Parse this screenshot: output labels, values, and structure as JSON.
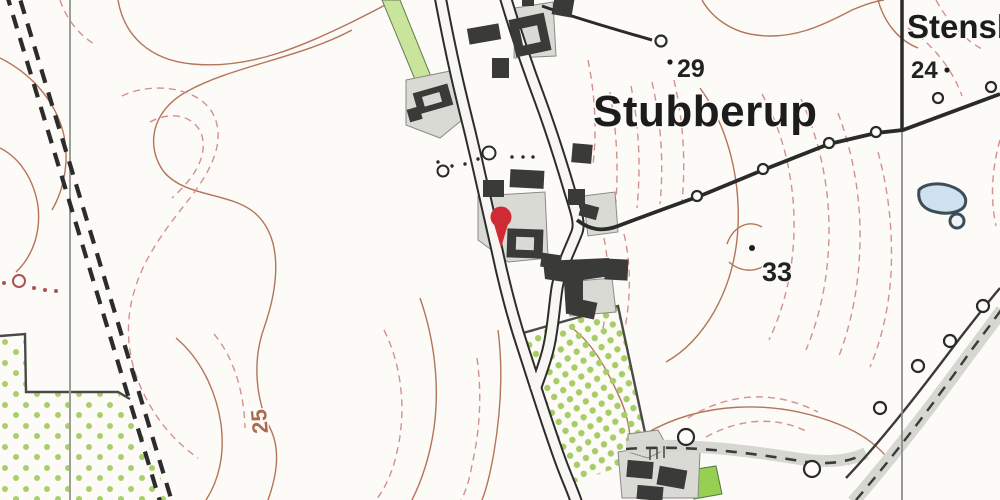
{
  "map": {
    "kind": "topographic-map",
    "labels": {
      "village": "Stubberup",
      "place_top_right": "Stensb",
      "spot_height_29": "29",
      "spot_height_33": "33",
      "spot_height_24": "24",
      "contour_label_25": "25"
    },
    "marker": {
      "type": "location-pin",
      "color": "#d02b35",
      "x": 500,
      "y": 218
    },
    "colors": {
      "background": "#fcfbf7",
      "contour_solid": "#b5745a",
      "contour_dashed": "#d4908e",
      "vegetation_dot": "#a9cf6c",
      "vegetation_strip": "#c9e49b",
      "vegetation_solid": "#96d052",
      "building": "#3a3a38",
      "yard": "#dadad5",
      "road_fill": "#f8f6f2",
      "road_casing": "#2c2c2a",
      "track_band": "#d7d7d2",
      "water_fill": "#cfe0ee",
      "water_outline": "#3e4e58",
      "pin": "#d02b35"
    }
  }
}
